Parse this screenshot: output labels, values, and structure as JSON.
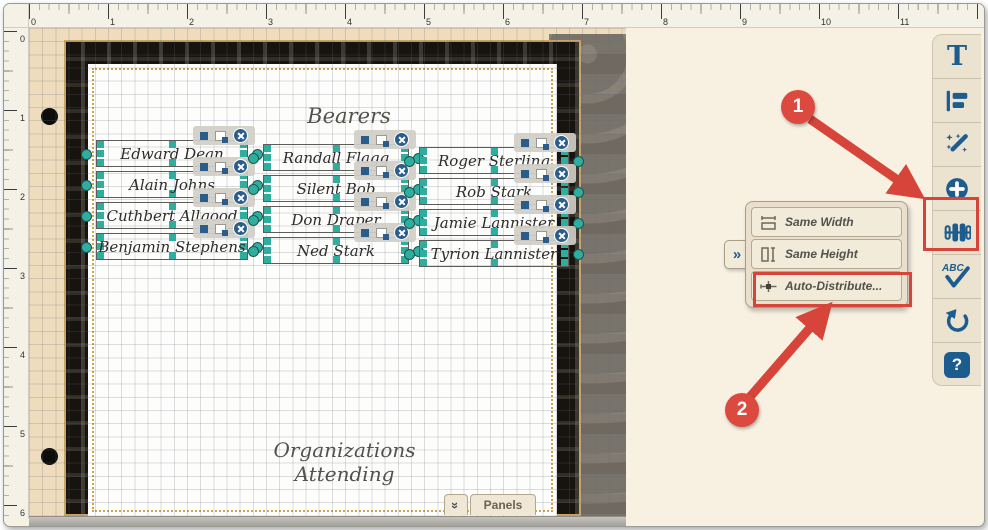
{
  "rulers": {
    "h": [
      "0",
      "1",
      "2",
      "3",
      "4",
      "5",
      "6",
      "7",
      "8",
      "9",
      "10",
      "11"
    ],
    "v": [
      "0",
      "1",
      "2",
      "3",
      "4",
      "5",
      "6"
    ]
  },
  "sheet": {
    "bearers_title": "Bearers",
    "organizations_title": "Organizations Attending",
    "name_columns": [
      [
        "Edward Dean",
        "Alain Johns",
        "Cuthbert Allgood",
        "Benjamin Stephens"
      ],
      [
        "Randall Flagg",
        "Silent Bob",
        "Don Draper",
        "Ned Stark"
      ],
      [
        "Roger Sterling",
        "Rob Stark",
        "Jamie Lannister",
        "Tyrion Lannister"
      ]
    ]
  },
  "panels_bar": {
    "label": "Panels",
    "collapse_glyph": "»"
  },
  "toolbar": {
    "buttons": [
      {
        "name": "text-tool",
        "glyph": "T"
      },
      {
        "name": "align-tool"
      },
      {
        "name": "magic-wand-tool"
      },
      {
        "name": "add-tool"
      },
      {
        "name": "distribute-tool"
      },
      {
        "name": "spellcheck-tool",
        "glyph": "ABC"
      },
      {
        "name": "rotate-tool"
      },
      {
        "name": "help-tool",
        "glyph": "?"
      }
    ]
  },
  "popup_menu": {
    "more_glyph": "»",
    "items": [
      {
        "label": "Same Width"
      },
      {
        "label": "Same Height"
      },
      {
        "label": "Auto-Distribute..."
      }
    ]
  },
  "callouts": {
    "step1": "1",
    "step2": "2"
  },
  "colors": {
    "accent_red": "#d6443a",
    "handle_teal": "#2fae9f",
    "icon_blue": "#1d5c8e",
    "canvas_tan": "#efdcbc",
    "panel_beige": "#f8f1e2"
  }
}
